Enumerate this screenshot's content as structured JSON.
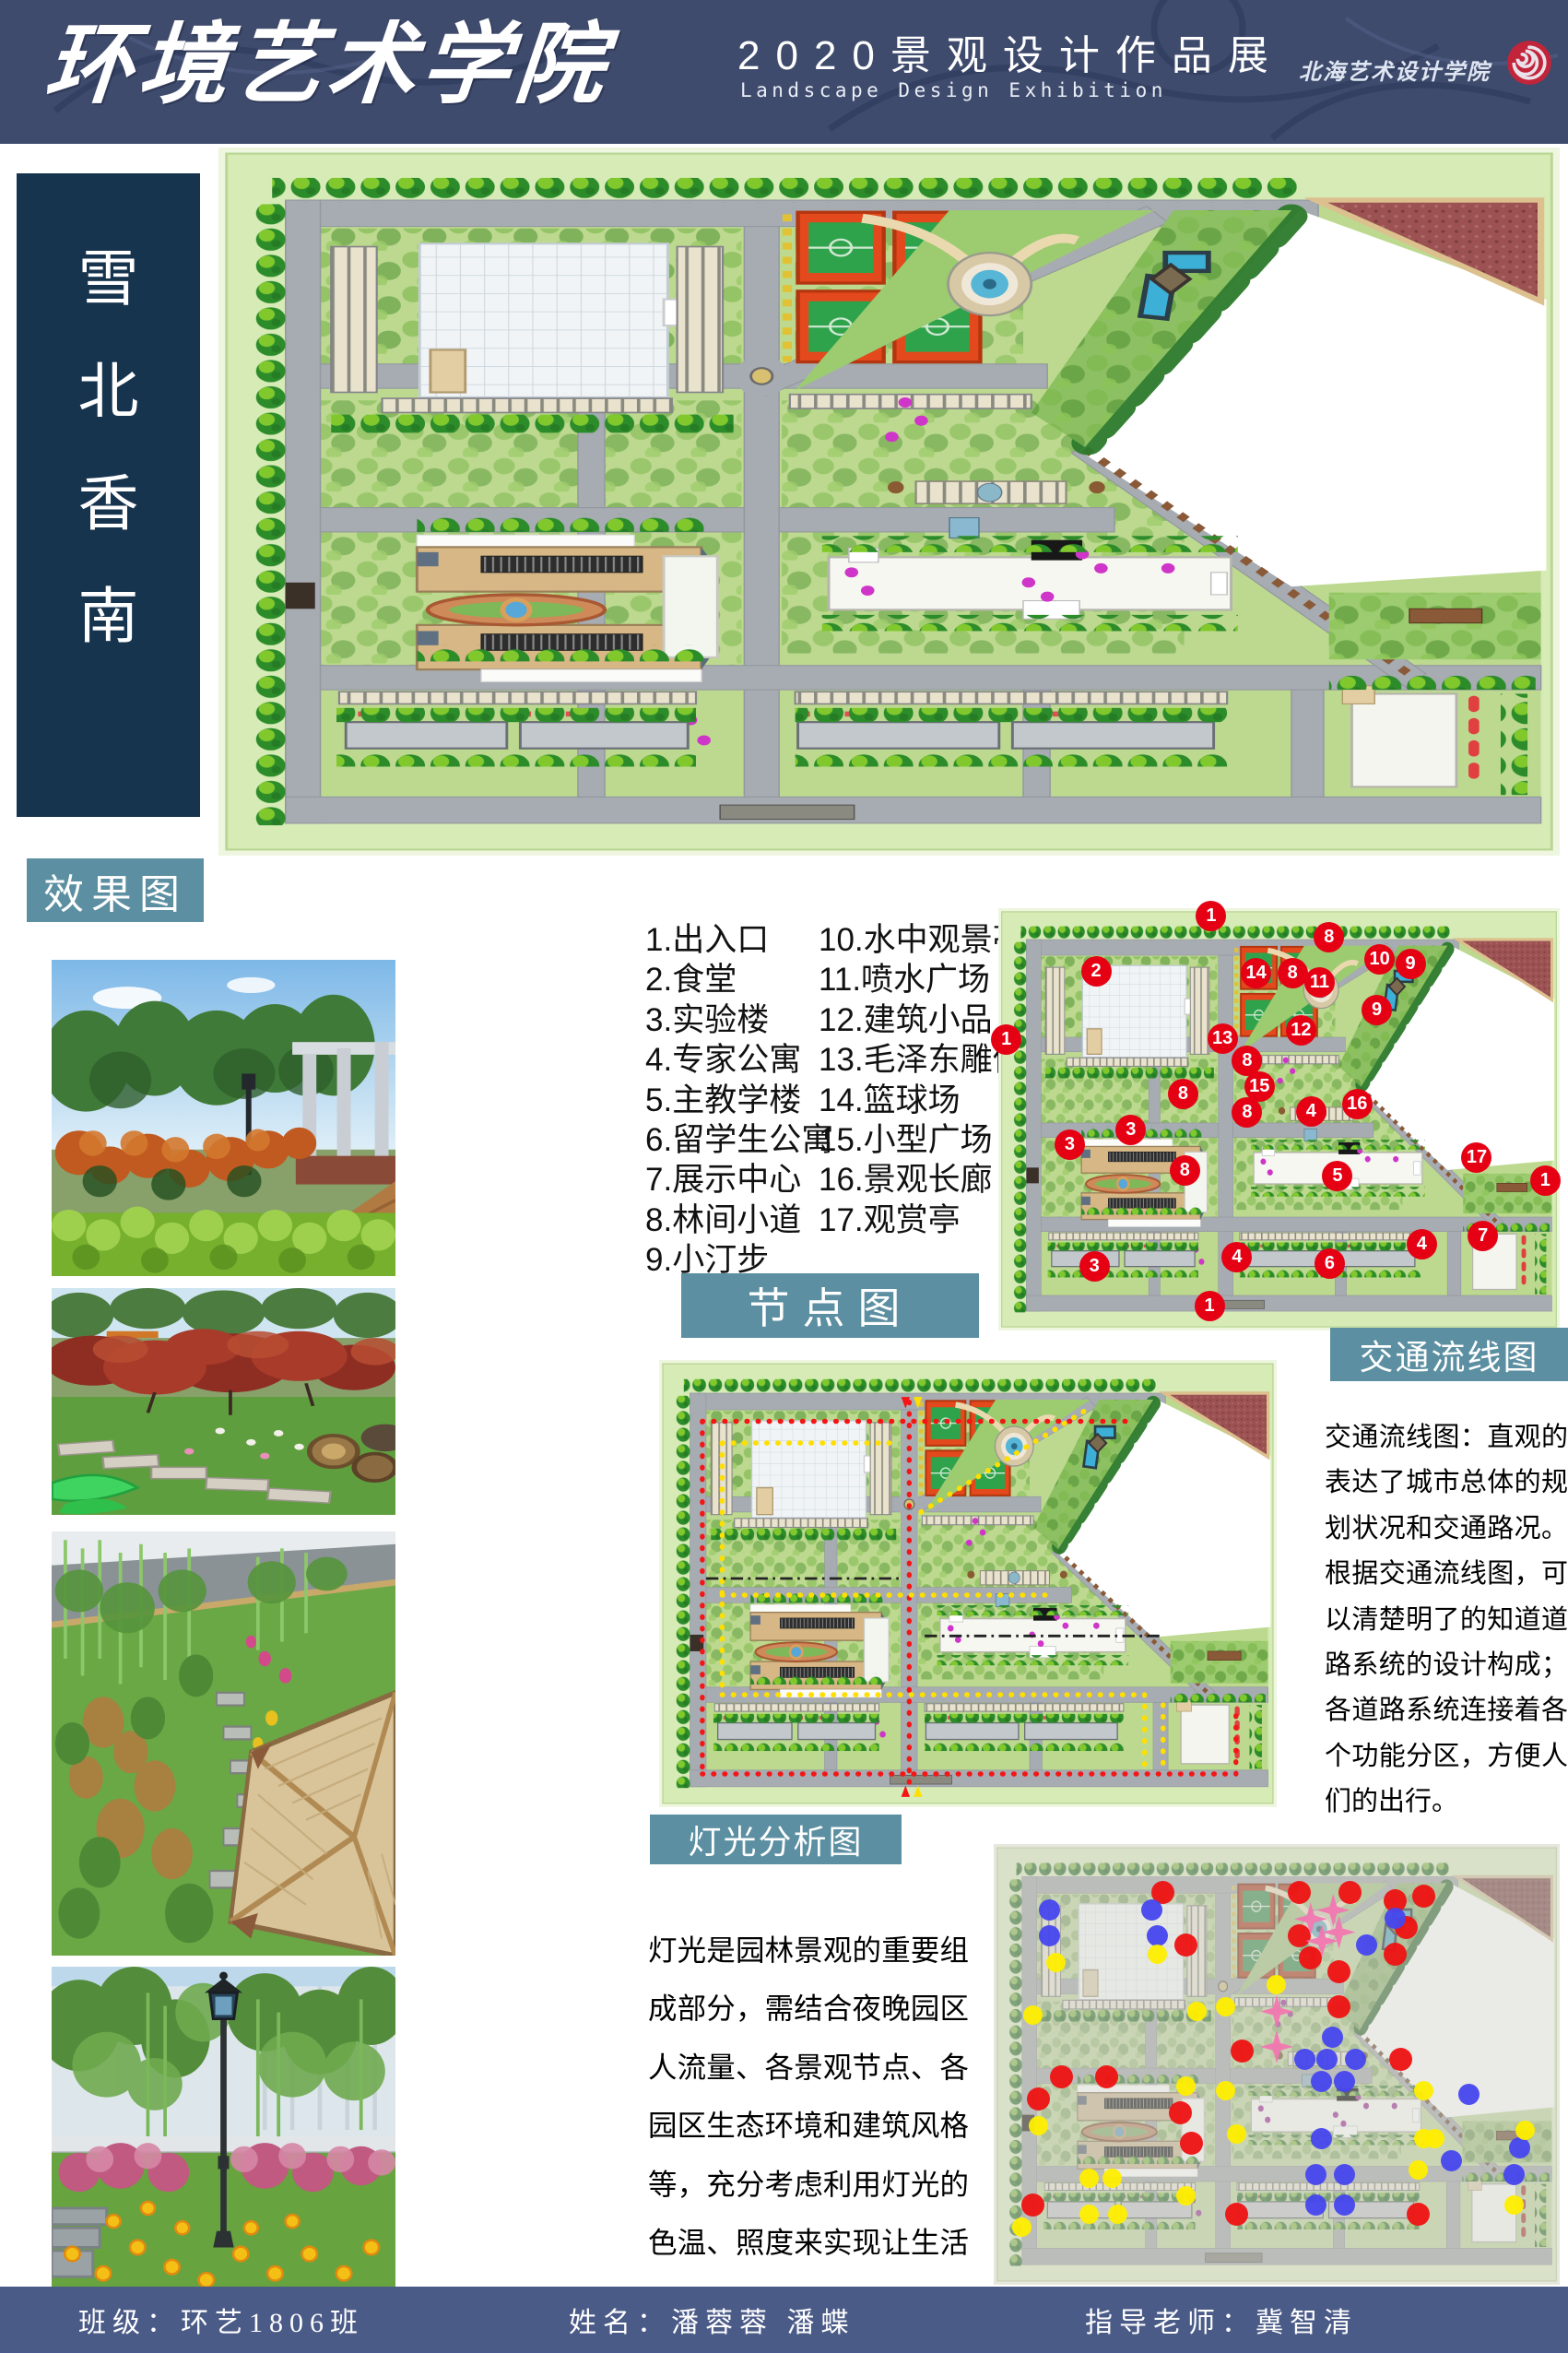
{
  "header": {
    "title": "环境艺术学院",
    "subtitle_cn": "2020景观设计作品展",
    "subtitle_en": "Landscape Design Exhibition",
    "institute_seal": "北海艺术设计学院"
  },
  "side_title": {
    "chars": [
      "雪",
      "北",
      "香",
      "南"
    ]
  },
  "labels": {
    "renderings": "效果图",
    "nodes": "节点图",
    "traffic": "交通流线图",
    "lighting": "灯光分析图"
  },
  "legend": {
    "col1": [
      "1.出入口",
      "2.食堂",
      "3.实验楼",
      "4.专家公寓",
      "5.主教学楼",
      "6.留学生公寓",
      "7.展示中心",
      "8.林间小道",
      "9.小汀步"
    ],
    "col2": [
      "10.水中观景亭",
      "11.喷水广场",
      "12.建筑小品",
      "13.毛泽东雕像",
      "14.篮球场",
      "15.小型广场",
      "16.景观长廊",
      "17.观赏亭"
    ]
  },
  "traffic_text": "交通流线图：直观的表达了城市总体的规划状况和交通路况。根据交通流线图，可以清楚明了的知道道路系统的设计构成；各道路系统连接着各个功能分区，方便人们的出行。",
  "lighting_text": "灯光是园林景观的重要组成部分，需结合夜晚园区人流量、各景观节点、各园区生态环境和建筑风格等，充分考虑利用灯光的色温、照度来实现让生活走进自然。",
  "footer": {
    "class": "班级：环艺1806班",
    "names": "姓名：潘蓉蓉  潘蝶",
    "advisor": "指导老师：冀智清"
  },
  "colors": {
    "teal": "#5b8fa1",
    "header_bg": "#3f4b6d",
    "side_bg": "#17344f",
    "footer_bg": "#4b5b88",
    "marker_red": "#e60014",
    "light_red": "#ee1212",
    "light_blue": "#4646ee",
    "light_yellow": "#ffee00",
    "star_pink": "#f177b0"
  },
  "node_markers": [
    {
      "n": "1",
      "x": 38,
      "y": 2
    },
    {
      "n": "2",
      "x": 17.5,
      "y": 15
    },
    {
      "n": "8",
      "x": 59,
      "y": 7
    },
    {
      "n": "14",
      "x": 46,
      "y": 15.6
    },
    {
      "n": "8",
      "x": 52.5,
      "y": 15.6
    },
    {
      "n": "10",
      "x": 68,
      "y": 12.3
    },
    {
      "n": "9",
      "x": 73.5,
      "y": 13.3
    },
    {
      "n": "11",
      "x": 57.3,
      "y": 17.7
    },
    {
      "n": "9",
      "x": 67.5,
      "y": 24.2
    },
    {
      "n": "12",
      "x": 54,
      "y": 29
    },
    {
      "n": "13",
      "x": 40,
      "y": 31
    },
    {
      "n": "1",
      "x": 1.5,
      "y": 31.3
    },
    {
      "n": "8",
      "x": 44.4,
      "y": 36.3
    },
    {
      "n": "15",
      "x": 46.6,
      "y": 42.4
    },
    {
      "n": "8",
      "x": 33,
      "y": 44
    },
    {
      "n": "8",
      "x": 44.4,
      "y": 48.5
    },
    {
      "n": "4",
      "x": 55.8,
      "y": 48.2
    },
    {
      "n": "16",
      "x": 64,
      "y": 46.5
    },
    {
      "n": "3",
      "x": 23.7,
      "y": 52.7
    },
    {
      "n": "3",
      "x": 12.8,
      "y": 56.1
    },
    {
      "n": "8",
      "x": 33.3,
      "y": 62.2
    },
    {
      "n": "17",
      "x": 85.3,
      "y": 59.2
    },
    {
      "n": "1",
      "x": 97.5,
      "y": 64.6
    },
    {
      "n": "5",
      "x": 60.5,
      "y": 63.5
    },
    {
      "n": "7",
      "x": 86.4,
      "y": 77.7
    },
    {
      "n": "4",
      "x": 42.6,
      "y": 82.7
    },
    {
      "n": "6",
      "x": 59.1,
      "y": 84.2
    },
    {
      "n": "4",
      "x": 75.5,
      "y": 79.7
    },
    {
      "n": "3",
      "x": 17.2,
      "y": 85
    },
    {
      "n": "1",
      "x": 37.7,
      "y": 94.4
    }
  ],
  "light_points": {
    "red": [
      [
        30,
        11
      ],
      [
        54,
        11
      ],
      [
        63,
        11
      ],
      [
        71,
        13
      ],
      [
        76,
        12
      ],
      [
        34,
        23
      ],
      [
        54,
        21
      ],
      [
        73,
        19
      ],
      [
        56,
        26
      ],
      [
        61,
        29
      ],
      [
        71,
        25
      ],
      [
        61,
        37
      ],
      [
        44,
        47
      ],
      [
        72,
        49
      ],
      [
        12,
        53
      ],
      [
        20,
        53
      ],
      [
        8,
        58
      ],
      [
        33,
        61
      ],
      [
        35,
        68
      ],
      [
        7,
        82
      ],
      [
        43,
        84
      ],
      [
        75,
        84
      ]
    ],
    "blue": [
      [
        10,
        15
      ],
      [
        28,
        15
      ],
      [
        10,
        21
      ],
      [
        29,
        21
      ],
      [
        71,
        17
      ],
      [
        66,
        23
      ],
      [
        60,
        44
      ],
      [
        55,
        49
      ],
      [
        59,
        49
      ],
      [
        64,
        49
      ],
      [
        58,
        54
      ],
      [
        62,
        54
      ],
      [
        58,
        67
      ],
      [
        84,
        57
      ],
      [
        57,
        75
      ],
      [
        62,
        75
      ],
      [
        81,
        72
      ],
      [
        57,
        82
      ],
      [
        62,
        82
      ],
      [
        93,
        69
      ],
      [
        92,
        75
      ]
    ],
    "yellow": [
      [
        11,
        27
      ],
      [
        29,
        25
      ],
      [
        50,
        32
      ],
      [
        36,
        38
      ],
      [
        41,
        37
      ],
      [
        7,
        39
      ],
      [
        34,
        55
      ],
      [
        41,
        56
      ],
      [
        8,
        64
      ],
      [
        76,
        56
      ],
      [
        78,
        67
      ],
      [
        17,
        76
      ],
      [
        21,
        76
      ],
      [
        34,
        80
      ],
      [
        43,
        66
      ],
      [
        75,
        74
      ],
      [
        17,
        84
      ],
      [
        22,
        84
      ],
      [
        94,
        65
      ],
      [
        92,
        82
      ],
      [
        5,
        87
      ],
      [
        76,
        67
      ]
    ],
    "stars": [
      [
        60,
        15
      ],
      [
        56,
        17
      ],
      [
        61,
        20
      ],
      [
        58,
        22
      ],
      [
        50,
        38
      ],
      [
        50,
        46
      ]
    ]
  }
}
